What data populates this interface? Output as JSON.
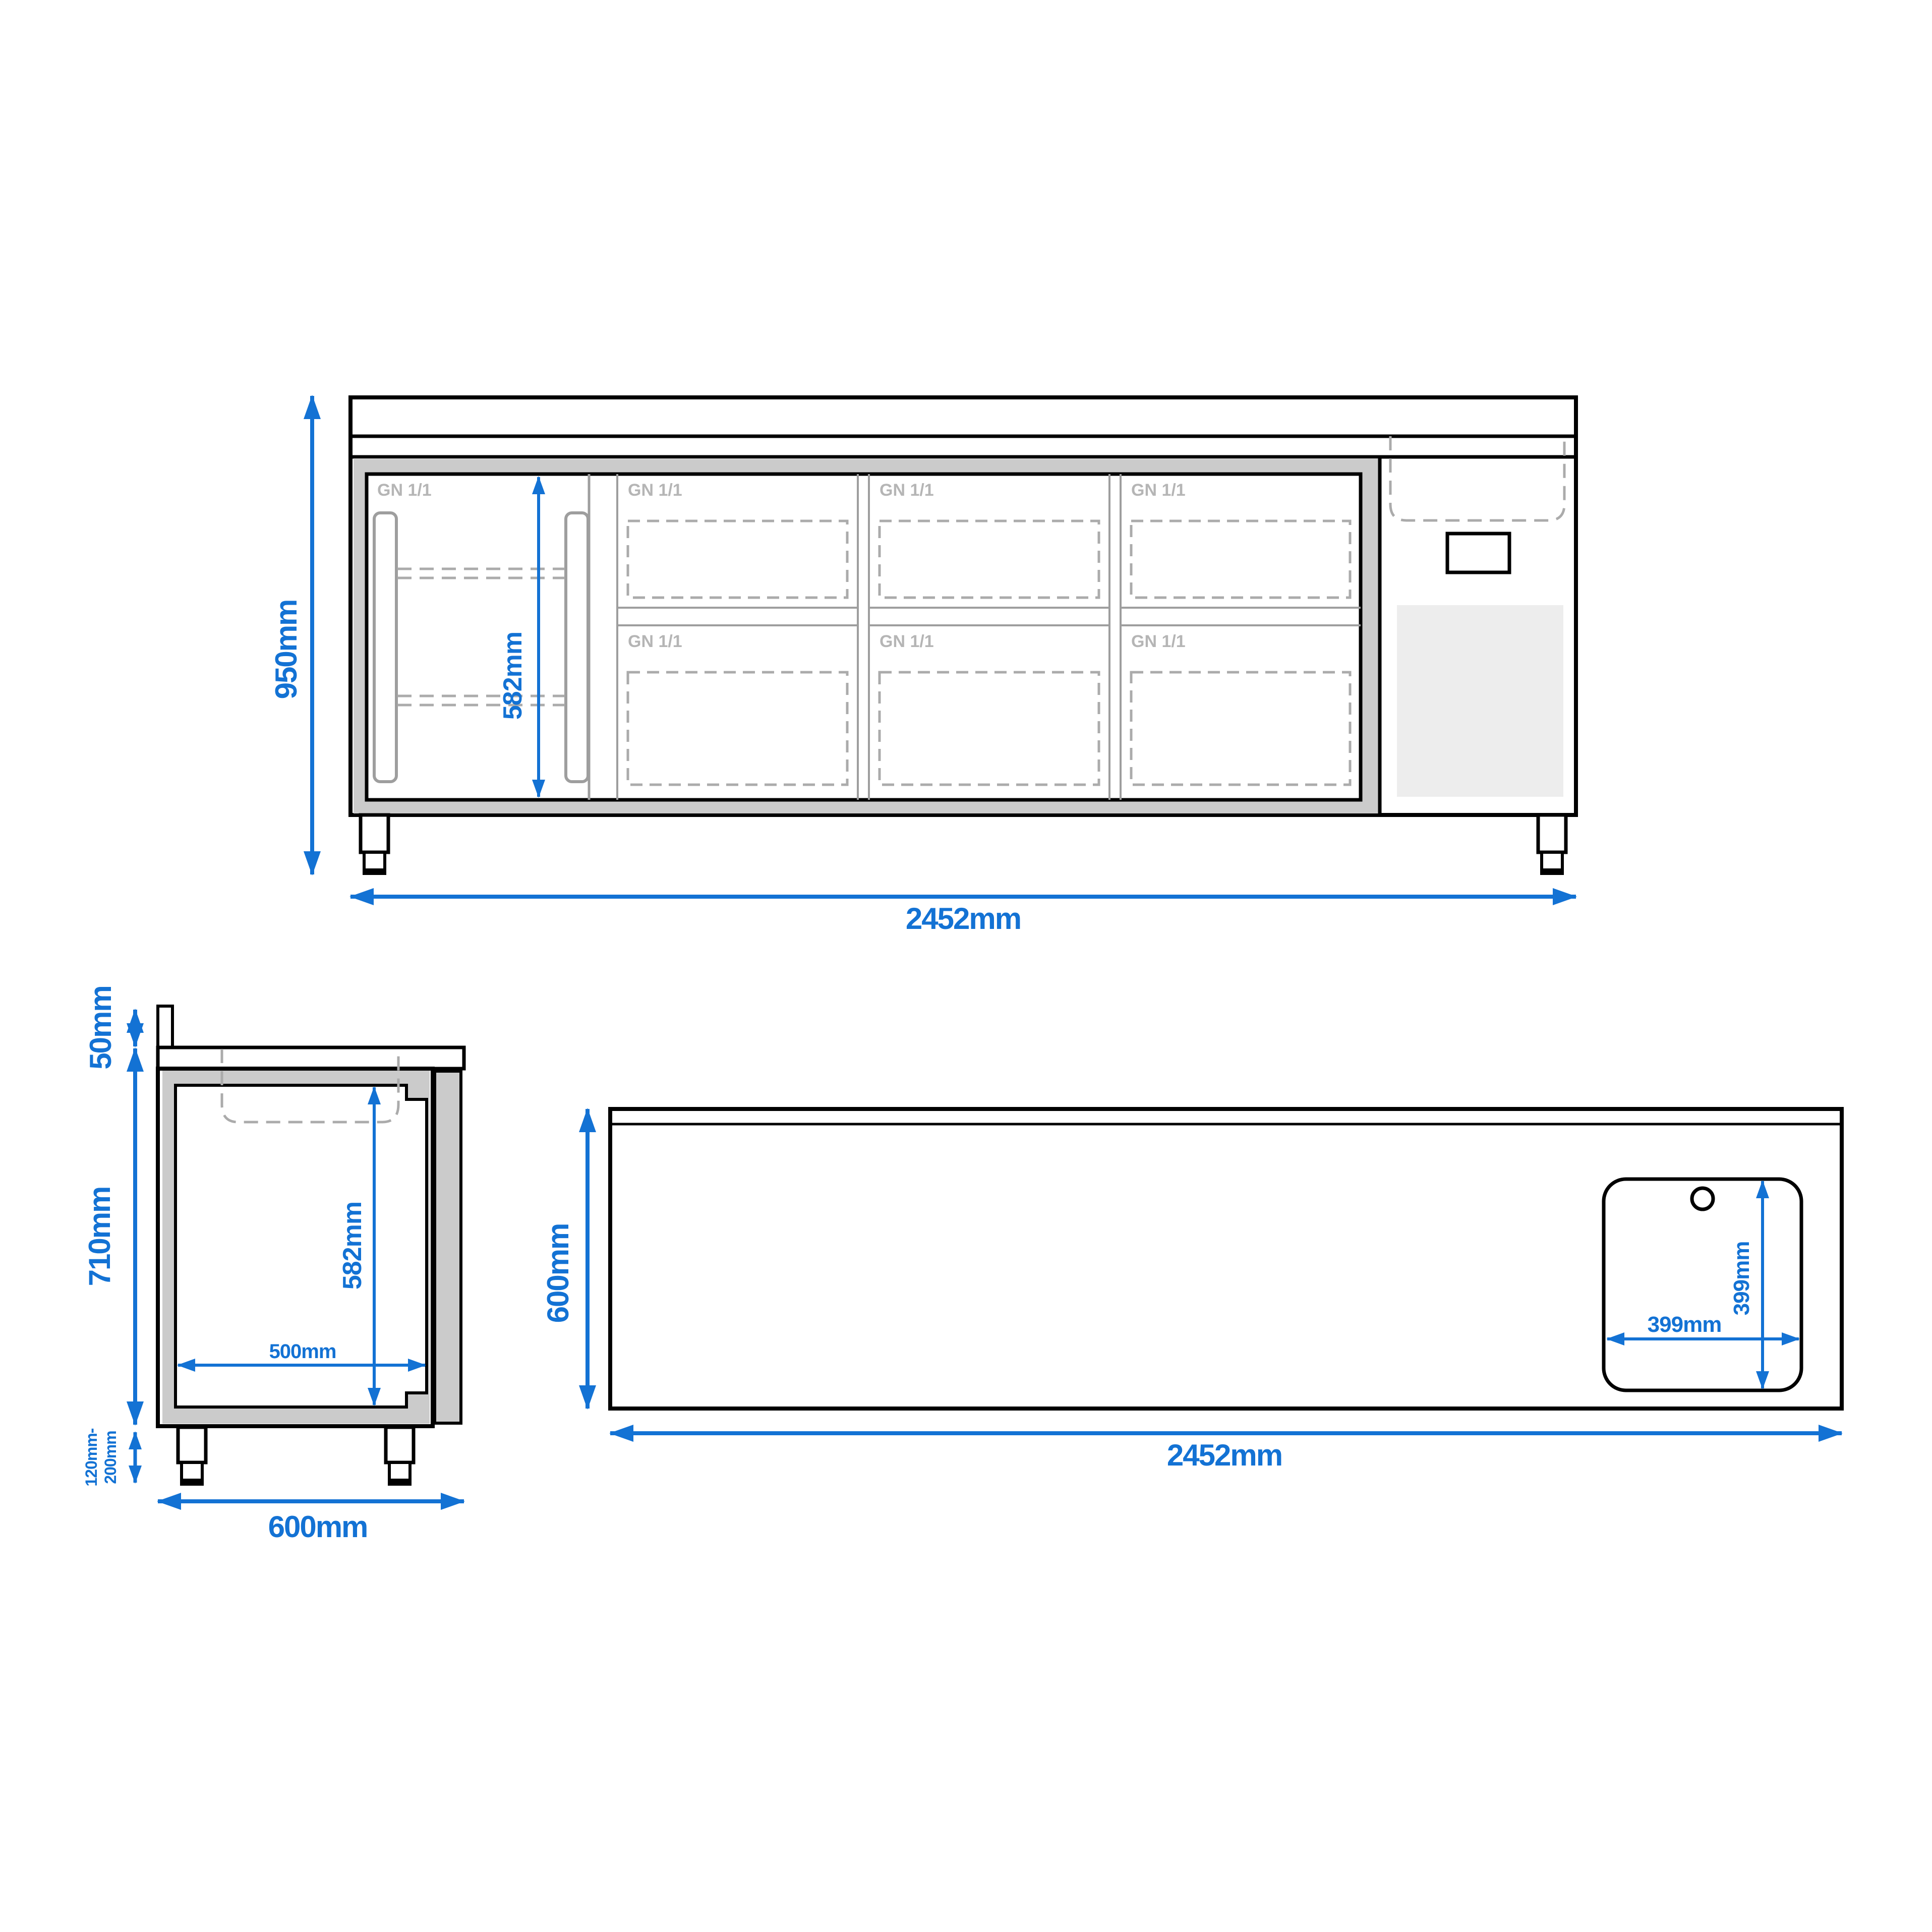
{
  "drawing": {
    "type": "technical-dimension-drawing",
    "subject": "refrigerated counter with door, drawers and sink",
    "views": {
      "front": {
        "overall_height": "950mm",
        "overall_width": "2452mm",
        "interior_height": "582mm",
        "gn_label": "GN 1/1",
        "gn_label_count": 7,
        "door_count": 1,
        "drawer_columns": 3,
        "drawer_rows": 2
      },
      "side": {
        "backsplash_height": "50mm",
        "body_height": "710mm",
        "interior_height": "582mm",
        "interior_depth": "500mm",
        "leg_height_line1": "120mm-",
        "leg_height_line2": "200mm",
        "overall_depth": "600mm"
      },
      "top": {
        "overall_depth": "600mm",
        "overall_width": "2452mm",
        "sink_width": "399mm",
        "sink_depth": "399mm",
        "tap_hole_count": 1
      }
    },
    "colors": {
      "dimension_blue": "#1372d4",
      "outline_black": "#000000",
      "insulation_gray": "#cbcbcb",
      "line_gray": "#9e9e9e",
      "dashed_gray": "#ababab",
      "gn_label_gray": "#b5b5b5",
      "vent_gray": "#ededed",
      "background": "#ffffff"
    }
  }
}
